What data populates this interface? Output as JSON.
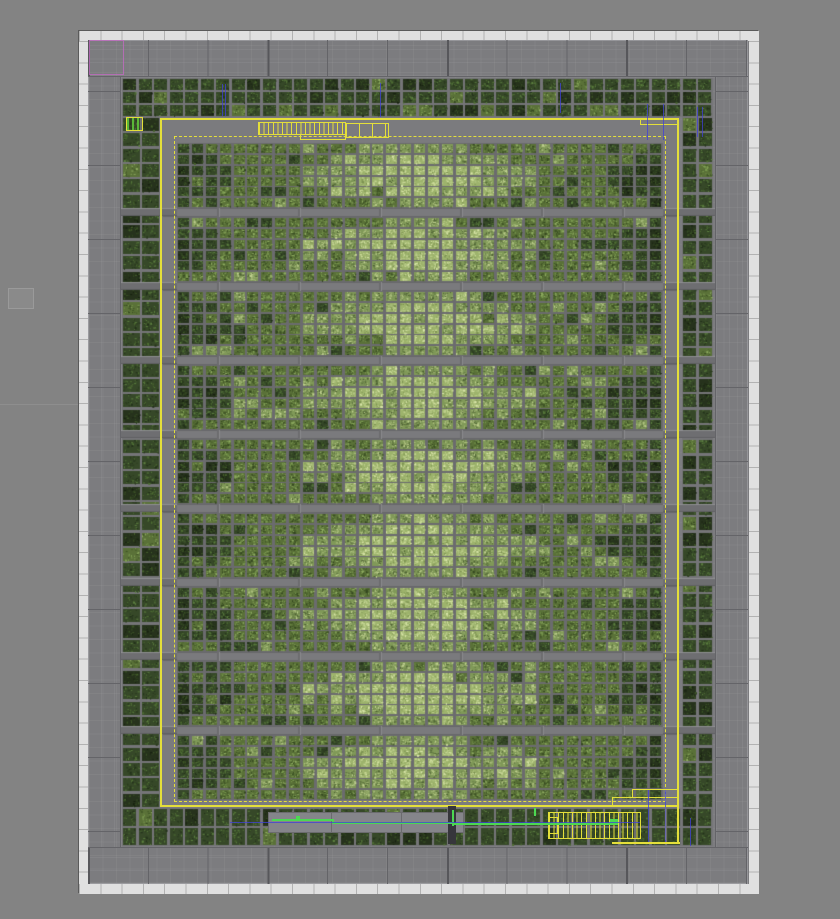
{
  "viewport": {
    "w": 840,
    "h": 919,
    "bg": "#838383"
  },
  "colors": {
    "yellow": "#e4df3a",
    "green_net": "#4cd852",
    "green_cell_bar": "#5ab838",
    "blue_net": "#4040d8",
    "magenta": "#c06ac0",
    "bg": "#838383",
    "die_border": "#5a5a5a",
    "seal_white": "#e0e0e0",
    "seal_line": "#b2b2b2",
    "seal_inner_edge": "#96969a",
    "pad_gray": "#7c7c7f",
    "divider": "#646468",
    "divider_strong": "#57575b",
    "field_gray": "#7d7d80",
    "corridor_gray": "#7b7b7e",
    "channel_gray": "#7a7a7d",
    "channel_edge": "#68686b",
    "tick_gray": "#6c6c6f",
    "tick_light": "#8a8a8d",
    "bar_gray": "#6e6e71",
    "bar_light": "#8f8f92",
    "bar_dark": "#606063",
    "tile_gap_core": "#6b6b6e",
    "tile_gap_perim": "#757578",
    "module_gray": "#85858a",
    "module_border": "#6b6b6e",
    "dark_block": "#36363b"
  },
  "die": {
    "x": 78,
    "y": 30,
    "w": 680,
    "h": 863,
    "seal": 10,
    "seal_pitch": 21.3
  },
  "padring": {
    "x": 88,
    "y": 40,
    "w": 660,
    "h": 844
  },
  "pads": [
    {
      "name": "io-pad-row-top",
      "x": 88,
      "y": 40,
      "w": 660,
      "h": 37,
      "orient": "h",
      "pitch": 59.8,
      "strong": 179.4,
      "edge": "bottom"
    },
    {
      "name": "io-pad-row-bottom",
      "x": 88,
      "y": 847,
      "w": 660,
      "h": 37,
      "orient": "h",
      "pitch": 59.8,
      "strong": 179.4,
      "edge": "top"
    },
    {
      "name": "io-pad-col-left",
      "x": 88,
      "y": 77,
      "w": 33,
      "h": 770,
      "orient": "v",
      "pitch": 74,
      "offset": 14,
      "edge": "right"
    },
    {
      "name": "io-pad-col-right",
      "x": 715,
      "y": 77,
      "w": 33,
      "h": 770,
      "orient": "v",
      "pitch": 74,
      "offset": 14,
      "edge": "left"
    }
  ],
  "field": {
    "x": 121,
    "y": 77,
    "w": 594,
    "h": 770,
    "grid": 13.9
  },
  "perimeter_strips": [
    [
      122,
      78,
      591,
      39
    ],
    [
      122,
      808,
      591,
      38
    ],
    [
      122,
      117,
      38,
      691
    ],
    [
      682,
      117,
      31,
      691
    ]
  ],
  "perimeter_tile": {
    "pitch": 15.4,
    "gap": 2.2
  },
  "corridor": {
    "x": 160,
    "y": 117,
    "w": 520,
    "h": 691
  },
  "ring_outer": {
    "x": 160,
    "y": 118,
    "w": 519,
    "h": 689
  },
  "ring_inner": {
    "x": 174,
    "y": 136,
    "w": 492,
    "h": 666
  },
  "core": {
    "x": 177,
    "y": 143,
    "w": 486,
    "bands": 9,
    "band_h": 65,
    "gap": 9,
    "cols": 35,
    "rows": 6,
    "tile_gap": 1.4,
    "tick_pitch": 81
  },
  "diamond": {
    "bright_t": 0.57,
    "bright_core": 0.36,
    "bright_vs": 0.45,
    "dark_t": 0.7,
    "dark_core": 0.88,
    "dark_vs": 0.28
  },
  "bars": {
    "left_x": 121,
    "left_w": 56,
    "right_x": 663,
    "right_w": 52,
    "h": 8
  },
  "core_levels": [
    {
      "base": "#26321c",
      "speckles": [
        "#16200f",
        "#3b5226",
        "#2c3d20",
        "#46622c"
      ]
    },
    {
      "base": "#364828",
      "speckles": [
        "#22301a",
        "#4f6e33",
        "#5d8040",
        "#2a3a1e"
      ]
    },
    {
      "base": "#5a7138",
      "speckles": [
        "#3f5526",
        "#7b9b50",
        "#90ad62",
        "#33461f"
      ]
    },
    {
      "base": "#809958",
      "speckles": [
        "#5d7340",
        "#aec07f",
        "#c2d292",
        "#4d6133"
      ]
    },
    {
      "base": "#9db36c",
      "speckles": [
        "#c9d996",
        "#dae6ab",
        "#7b9150",
        "#b4c785"
      ]
    }
  ],
  "yellow_structures": [
    {
      "name": "bus-comb-top-left",
      "kind": "comb",
      "rect": [
        258,
        122,
        88,
        13
      ],
      "finger_pitch": 4.6
    },
    {
      "name": "bus-box-top",
      "kind": "comb",
      "rect": [
        345,
        123,
        44,
        15
      ],
      "finger_pitch": 13
    },
    {
      "name": "bus-notch-top",
      "kind": "outline",
      "rect": [
        300,
        134,
        46,
        6
      ]
    },
    {
      "name": "ring-thick-top-right",
      "kind": "outline",
      "rect": [
        640,
        118,
        39,
        7
      ]
    },
    {
      "name": "ring-step-bottom-right",
      "kind": "outline",
      "rect": [
        612,
        797,
        67,
        10
      ]
    },
    {
      "name": "ring-step2-bottom-right",
      "kind": "outline",
      "rect": [
        632,
        789,
        47,
        9
      ]
    },
    {
      "name": "bus-comb-bottom-right",
      "kind": "comb",
      "rect": [
        548,
        812,
        93,
        27
      ],
      "finger_pitch": 4.6
    },
    {
      "name": "bus-box-bottom-right",
      "kind": "outline",
      "rect": [
        548,
        817,
        10,
        17
      ]
    },
    {
      "name": "yellow-line-bottom",
      "kind": "bar",
      "rect": [
        612,
        842,
        68,
        2
      ]
    },
    {
      "name": "yellow-vert-bottom-a",
      "kind": "bar",
      "rect": [
        677,
        807,
        2,
        36
      ]
    },
    {
      "name": "yellow-vert-bottom-b",
      "kind": "bar",
      "rect": [
        665,
        807,
        1,
        33
      ]
    }
  ],
  "mini_cell": {
    "rect": [
      126,
      117,
      17,
      14
    ],
    "bar_pitch": 5
  },
  "module": {
    "rect": [
      268,
      812,
      196,
      21
    ],
    "dividers": [
      330,
      400
    ]
  },
  "dark_block": {
    "rect": [
      448,
      806,
      8,
      38
    ]
  },
  "green_nets": [
    [
      272,
      819,
      60,
      2
    ],
    [
      332,
      819,
      2,
      5
    ],
    [
      332,
      822,
      120,
      2
    ],
    [
      452,
      810,
      2,
      16
    ],
    [
      452,
      823,
      166,
      2
    ],
    [
      534,
      808,
      2,
      8
    ],
    [
      296,
      816,
      4,
      4
    ],
    [
      610,
      819,
      8,
      5
    ]
  ],
  "blue_marks": [
    [
      222,
      84,
      1,
      32
    ],
    [
      225,
      84,
      1,
      32
    ],
    [
      380,
      83,
      1,
      34
    ],
    [
      560,
      83,
      1,
      30
    ],
    [
      647,
      104,
      1,
      36
    ],
    [
      663,
      104,
      1,
      36
    ],
    [
      697,
      107,
      1,
      30
    ],
    [
      702,
      107,
      1,
      30
    ],
    [
      648,
      790,
      1,
      52
    ],
    [
      665,
      790,
      1,
      52
    ],
    [
      690,
      818,
      1,
      28
    ],
    [
      230,
      822,
      410,
      1
    ]
  ],
  "magenta_pad": {
    "rect": [
      89,
      40,
      35,
      35
    ]
  },
  "background_artifacts": {
    "square": [
      8,
      288,
      26,
      21
    ],
    "seam": [
      0,
      404,
      78,
      1
    ]
  }
}
